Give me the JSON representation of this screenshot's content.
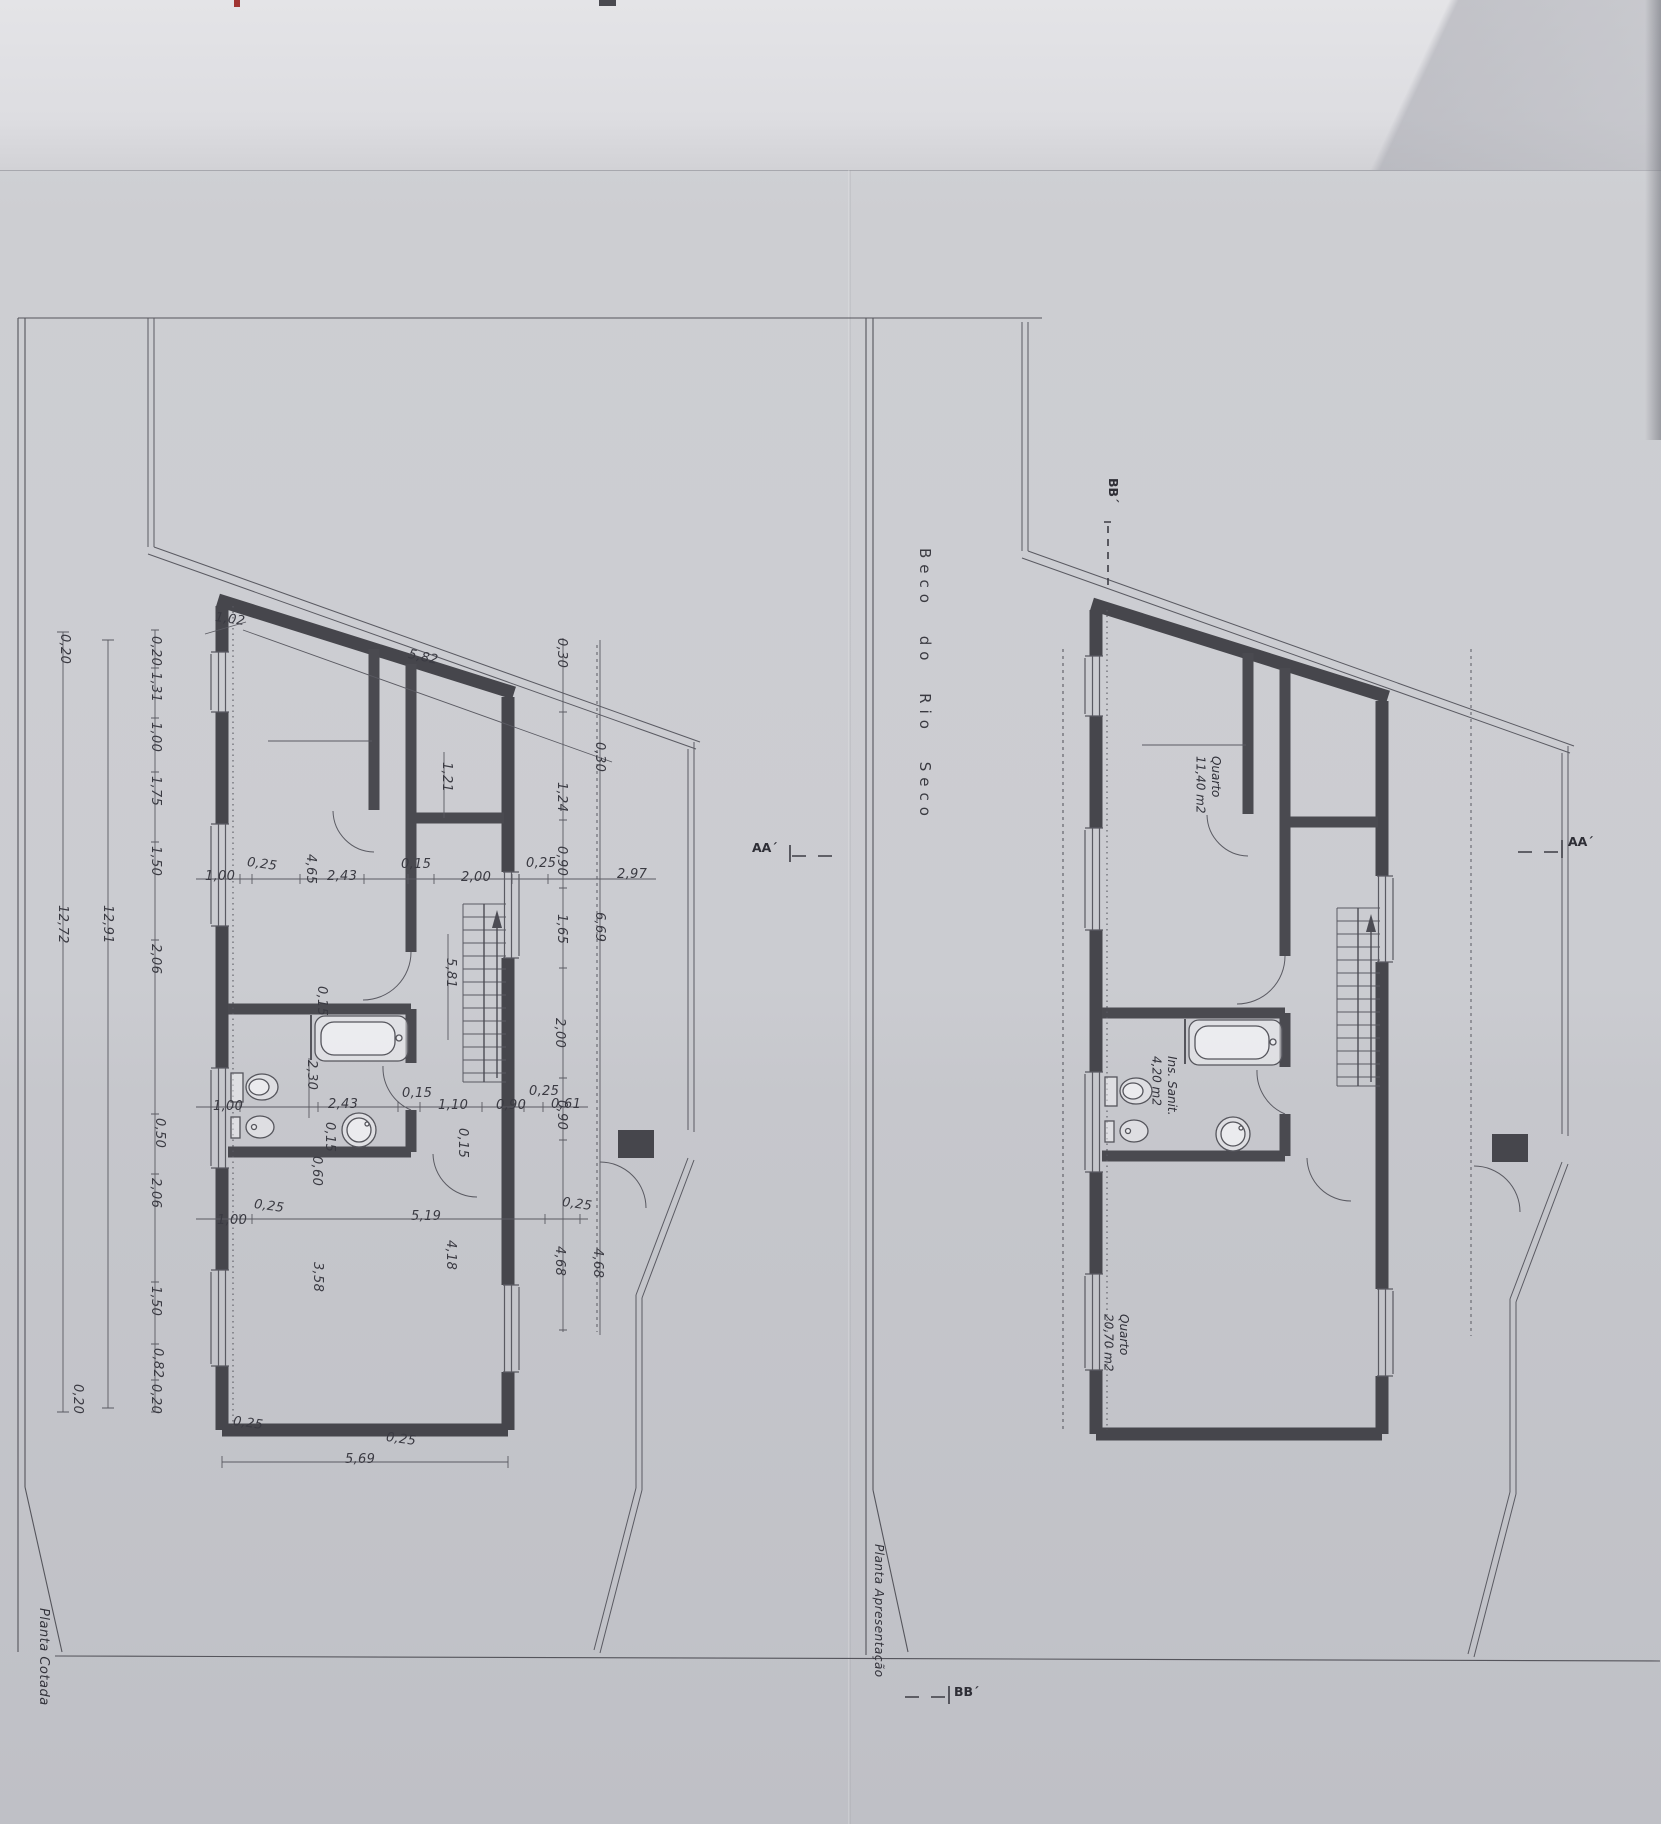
{
  "sheet": {
    "street": "Beco do Rio Seco",
    "left_title": "Planta Cotada",
    "right_title": "Planta Apresentação"
  },
  "sections": {
    "bb_top": "BB´",
    "bb_bottom": "BB´",
    "aa_left": "AA´",
    "aa_right": "AA´"
  },
  "rooms": {
    "quarto1": {
      "name": "Quarto",
      "area": "11,40 m2"
    },
    "sanit": {
      "name": "Ins. Sanit.",
      "area": "4,20 m2"
    },
    "quarto2": {
      "name": "Quarto",
      "area": "20,70 m2"
    }
  },
  "dims": {
    "top": [
      "1,02",
      "5,82"
    ],
    "left_chain": [
      "0,20",
      "1,31",
      "1,00",
      "1,75",
      "1,50",
      "2,06",
      "0,50",
      "2,06",
      "1,50",
      "0,82",
      "0,20"
    ],
    "left_totals": [
      "12,91",
      "12,72",
      "0,20",
      "0,20"
    ],
    "mid_line": [
      "1,00",
      "0,25",
      "4,65",
      "2,43",
      "0,15",
      "2,00",
      "0,25",
      "2,97"
    ],
    "right_col_inner": [
      "0,30",
      "1,24",
      "0,90",
      "1,65",
      "2,00",
      "0,90",
      "4,68"
    ],
    "right_col_outer": [
      "0,30",
      "6,69",
      "4,68"
    ],
    "inner_vertical": [
      "1,21",
      "5,81"
    ],
    "lower_line": [
      "1,00",
      "2,43",
      "0,15",
      "1,10",
      "0,90",
      "0,25",
      "0,61"
    ],
    "lower_vertical": [
      "0,15",
      "2,30",
      "0,15",
      "0,60",
      "0,15"
    ],
    "bottom_line": [
      "1,00",
      "0,25",
      "5,19",
      "0,25"
    ],
    "bottom_vertical": [
      "3,58",
      "4,18"
    ],
    "bottom": [
      "5,69",
      "0,25",
      "0,25"
    ]
  }
}
